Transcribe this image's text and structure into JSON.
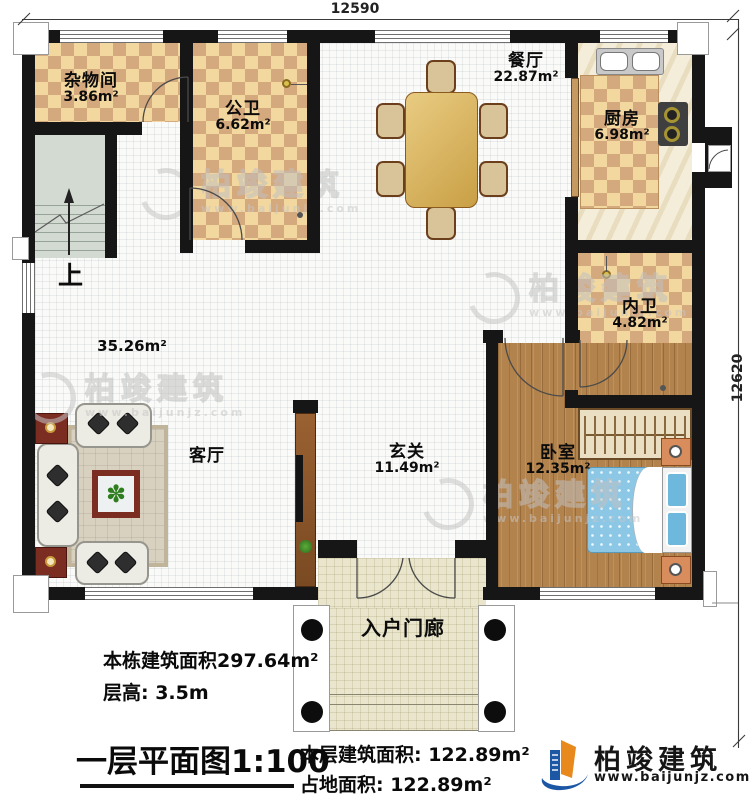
{
  "dimensions": {
    "top": "12590",
    "right": "12620"
  },
  "rooms": [
    {
      "id": "storage",
      "name": "杂物间",
      "area": "3.86m²"
    },
    {
      "id": "public-bath",
      "name": "公卫",
      "area": "6.62m²"
    },
    {
      "id": "dining",
      "name": "餐厅",
      "area": "22.87m²"
    },
    {
      "id": "kitchen",
      "name": "厨房",
      "area": "6.98m²"
    },
    {
      "id": "inner-bath",
      "name": "内卫",
      "area": "4.82m²"
    },
    {
      "id": "bedroom",
      "name": "卧室",
      "area": "12.35m²"
    },
    {
      "id": "living",
      "name": "客厅",
      "area": ""
    },
    {
      "id": "foyer",
      "name": "玄关",
      "area": "11.49m²"
    },
    {
      "id": "porch",
      "name": "入户门廊",
      "area": ""
    }
  ],
  "annotations": {
    "open_area": "35.26m²",
    "stairs_up": "上"
  },
  "title_block": {
    "building_total_area": "本栋建筑面积297.64m²",
    "floor_height": "层高: 3.5m",
    "plan_title": "一层平面图1:100",
    "floor_area": "本层建筑面积: 122.89m²",
    "footprint_area": "占地面积: 122.89m²"
  },
  "brand": {
    "name": "柏竣建筑",
    "url": "www.baijunjz.com"
  },
  "watermark": {
    "name": "柏竣建筑",
    "url": "www.baijunjz.com"
  },
  "colors": {
    "wall": "#161616",
    "checker_light": "#f2d79f",
    "checker_dark": "#d5a97e",
    "wood": "#b3834e",
    "bed_blue": "#8cc8e6",
    "brand_blue": "#1b57a5",
    "brand_orange": "#e8891d"
  }
}
